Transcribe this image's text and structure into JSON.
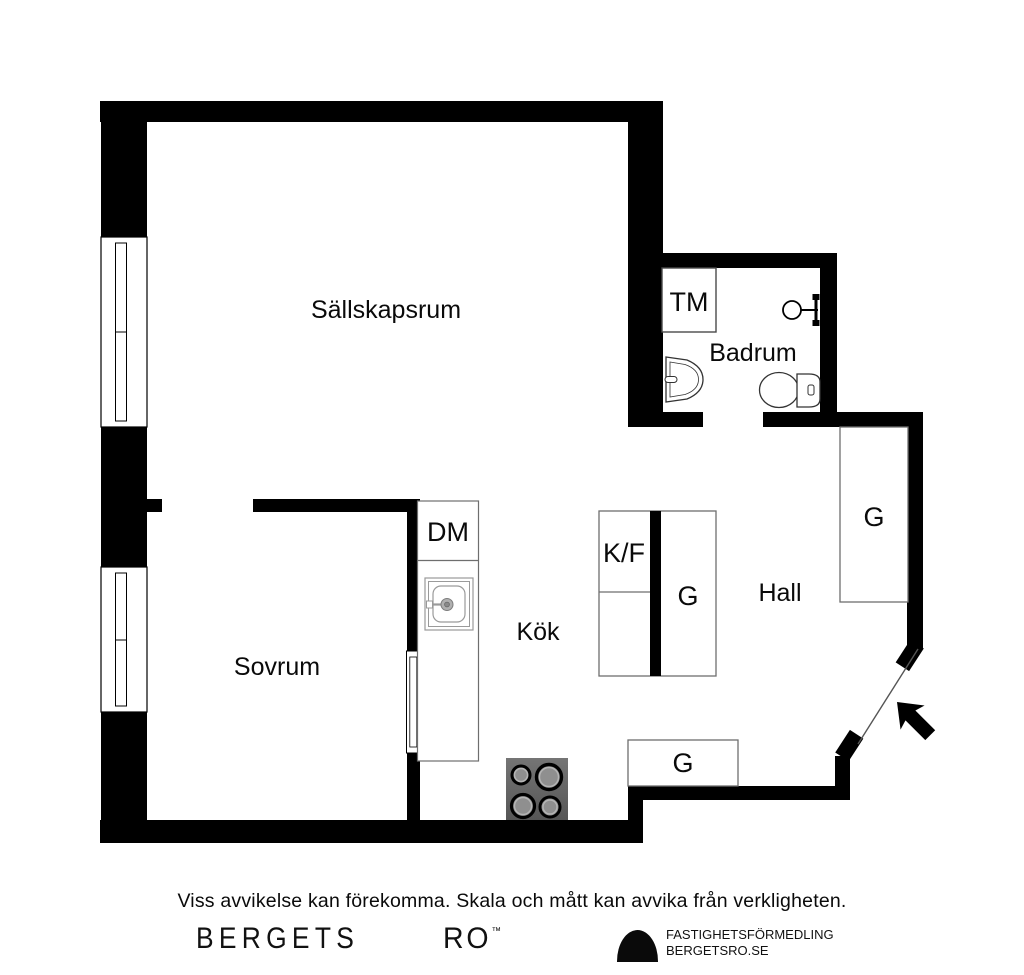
{
  "plan": {
    "labels": {
      "sallskapsrum": "Sällskapsrum",
      "badrum": "Badrum",
      "sovrum": "Sovrum",
      "kok": "Kök",
      "hall": "Hall",
      "tm": "TM",
      "dm": "DM",
      "kf": "K/F",
      "g_hall": "G",
      "g_unit": "G",
      "g_kitchen": "G"
    },
    "colors": {
      "wall": "#000000",
      "fixture_border": "#6e6e6e",
      "sink_line": "#9a9a9a",
      "stove_body_light": "#757575",
      "stove_body_dark": "#565656",
      "burner_fill": "#8f8f8f",
      "burner_ring": "#000000"
    }
  },
  "footer": {
    "disclaimer": "Viss avvikelse kan förekomma. Skala och mått kan avvika från verkligheten.",
    "brand_first": "BERGETS",
    "brand_second": "RO",
    "brand_tm": "™",
    "brand_line1": "FASTIGHETSFÖRMEDLING",
    "brand_line2": "BERGETSRO.SE"
  }
}
